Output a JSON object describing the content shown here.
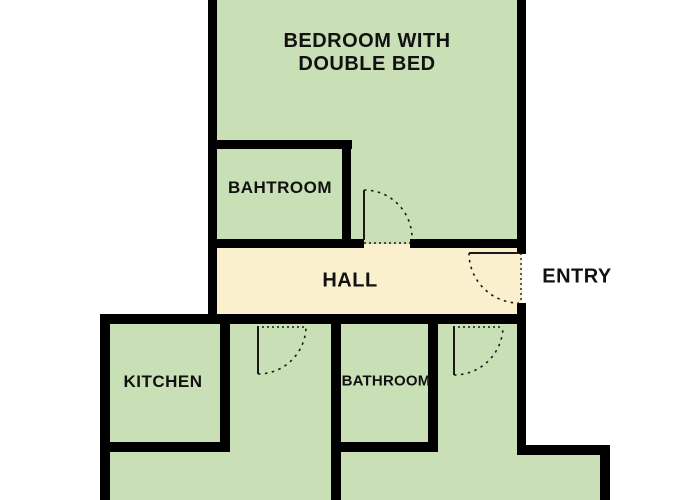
{
  "plan": {
    "title": "apartment-floor-plan",
    "rooms": {
      "bedroom": {
        "label_line1": "BEDROOM WITH",
        "label_line2": "DOUBLE BED"
      },
      "bathroom_top": {
        "label": "BAHTROOM"
      },
      "hall": {
        "label": "HALL"
      },
      "entry": {
        "label": "ENTRY"
      },
      "kitchen": {
        "label": "KITCHEN"
      },
      "bathroom_bottom": {
        "label": "BATHROOM"
      }
    },
    "colors": {
      "room_fill": "#c9dfb5",
      "hall_fill": "#fbf0ce",
      "wall": "#000000",
      "door_line": "#1a1a1a",
      "background": "#ffffff"
    },
    "door_count": 4
  }
}
